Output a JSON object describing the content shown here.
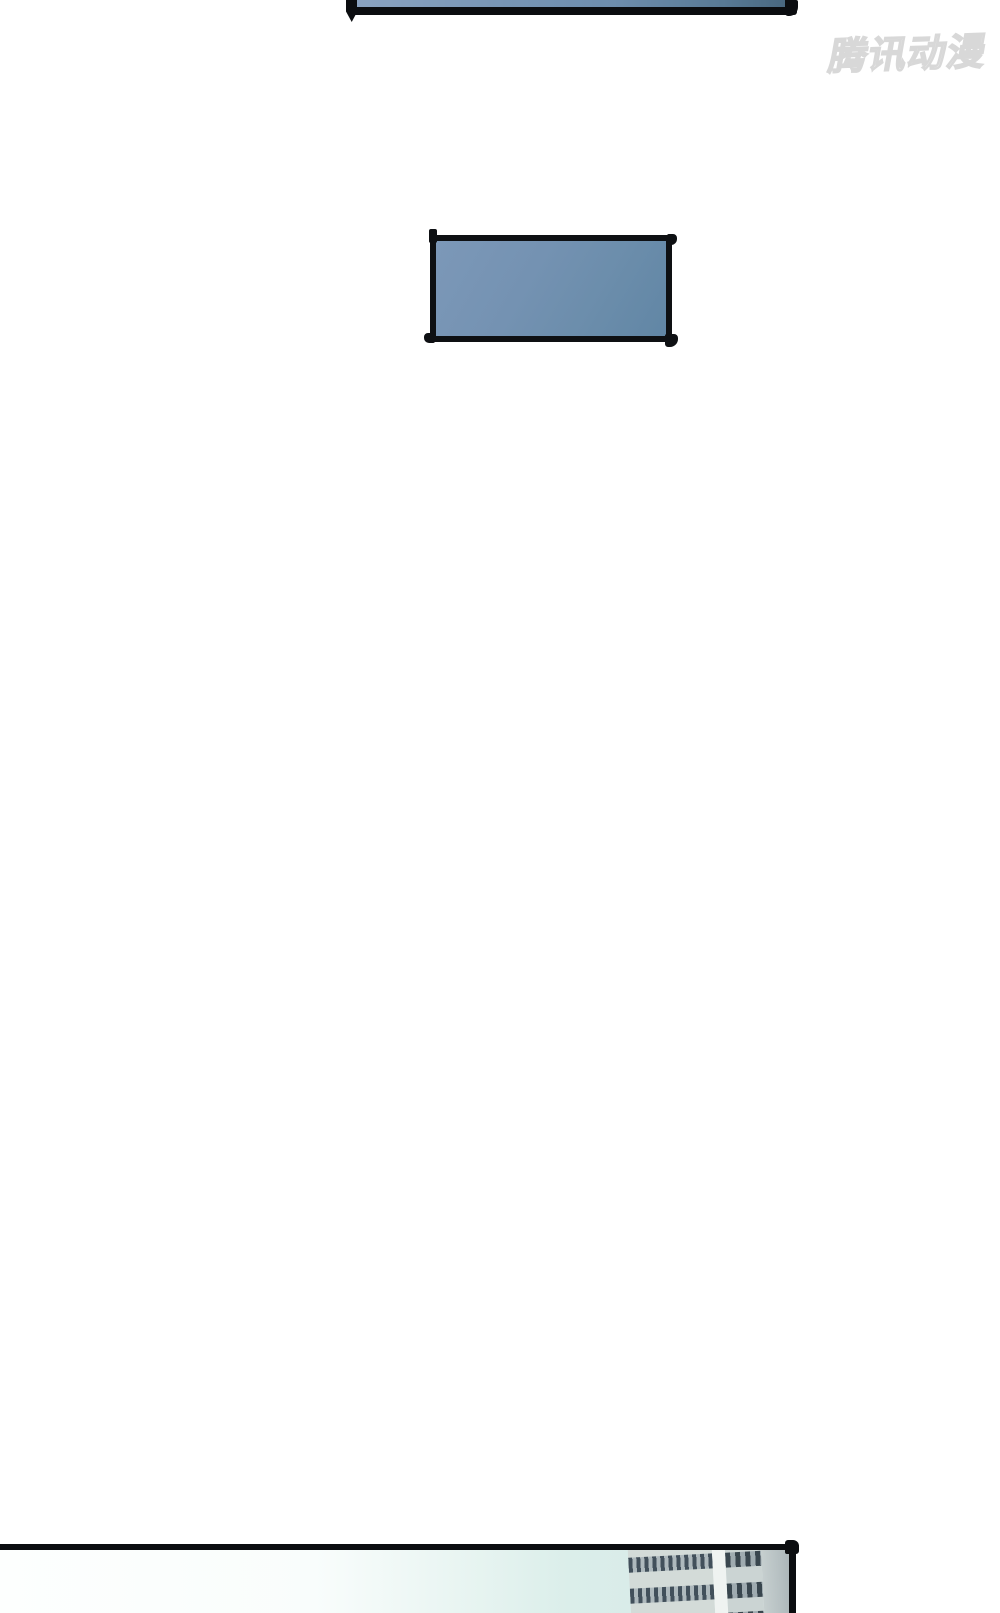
{
  "page": {
    "width": 1000,
    "height": 841,
    "background": "#ffffff"
  },
  "watermark": {
    "text": "腾讯动漫",
    "color": "#d8d8d8"
  },
  "panels": {
    "top": {
      "fill_left": "#8aa3c1",
      "fill_right": "#48677f",
      "border": "#0b0d10"
    },
    "middle": {
      "fill_start": "#7c98b8",
      "fill_end": "#6186a5",
      "border": "#0e1013"
    },
    "bottom": {
      "sky_left": "#fdfffe",
      "sky_right": "#d9ece9",
      "border": "#0b0d10",
      "building_face": "#d3dbd8",
      "building_window": "#42505b",
      "building_side": "#a7b1b4"
    }
  }
}
